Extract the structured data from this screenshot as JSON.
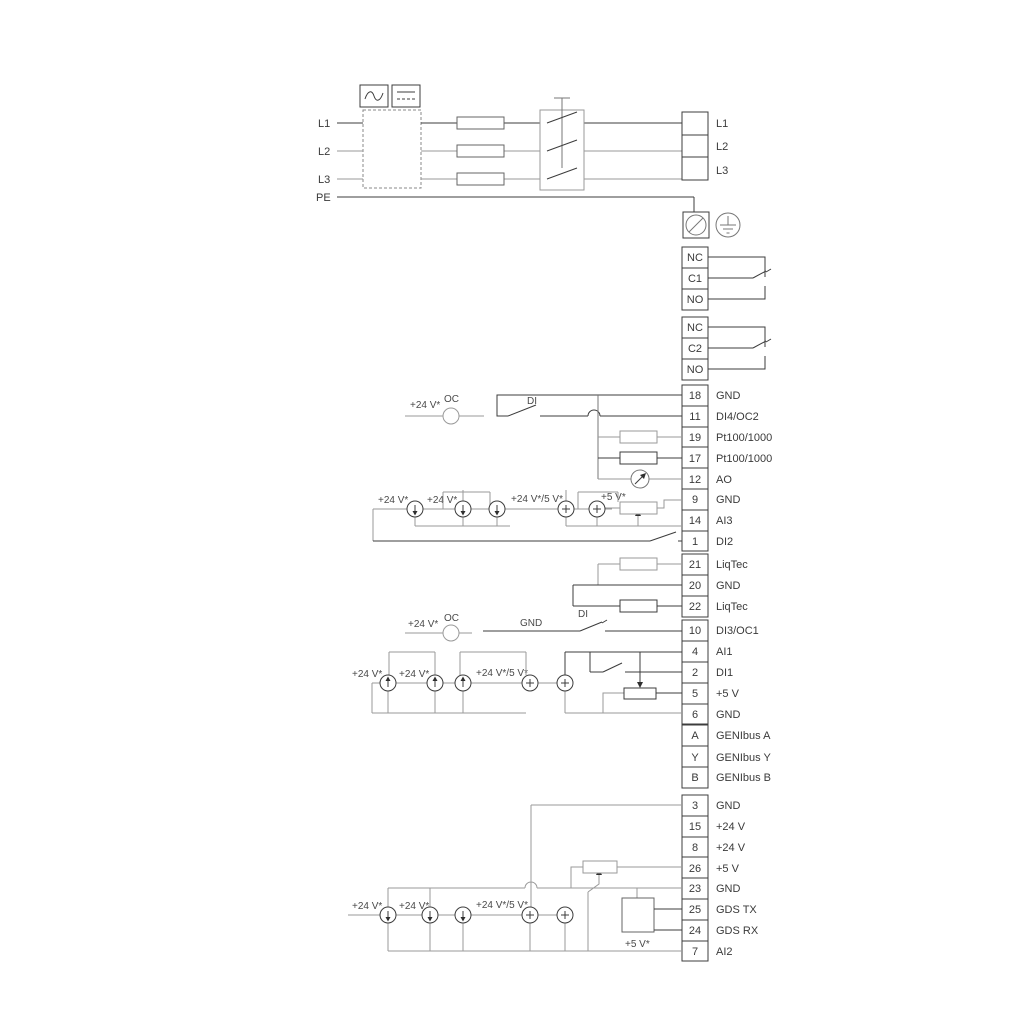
{
  "diagram": {
    "power": {
      "left": [
        "L1",
        "L2",
        "L3",
        "PE"
      ],
      "right": [
        "L1",
        "L2",
        "L3"
      ]
    },
    "relay1": {
      "nc": "NC",
      "common": "C1",
      "no": "NO"
    },
    "relay2": {
      "nc": "NC",
      "common": "C2",
      "no": "NO"
    },
    "strip1": {
      "rows": [
        {
          "num": "18",
          "label": "GND"
        },
        {
          "num": "11",
          "label": "DI4/OC2"
        },
        {
          "num": "19",
          "label": "Pt100/1000"
        },
        {
          "num": "17",
          "label": "Pt100/1000"
        },
        {
          "num": "12",
          "label": "AO"
        },
        {
          "num": "9",
          "label": "GND"
        },
        {
          "num": "14",
          "label": "AI3"
        },
        {
          "num": "1",
          "label": "DI2"
        }
      ]
    },
    "strip2": {
      "rows": [
        {
          "num": "21",
          "label": "LiqTec"
        },
        {
          "num": "20",
          "label": "GND"
        },
        {
          "num": "22",
          "label": "LiqTec"
        }
      ]
    },
    "strip3": {
      "rows": [
        {
          "num": "10",
          "label": "DI3/OC1"
        },
        {
          "num": "4",
          "label": "AI1"
        },
        {
          "num": "2",
          "label": "DI1"
        },
        {
          "num": "5",
          "label": "+5 V"
        },
        {
          "num": "6",
          "label": "GND"
        }
      ]
    },
    "genibus": {
      "rows": [
        {
          "num": "A",
          "label": "GENIbus A"
        },
        {
          "num": "Y",
          "label": "GENIbus Y"
        },
        {
          "num": "B",
          "label": "GENIbus B"
        }
      ]
    },
    "strip4": {
      "rows": [
        {
          "num": "3",
          "label": "GND"
        },
        {
          "num": "15",
          "label": "+24 V"
        },
        {
          "num": "8",
          "label": "+24 V"
        },
        {
          "num": "26",
          "label": "+5 V"
        },
        {
          "num": "23",
          "label": "GND"
        },
        {
          "num": "25",
          "label": "GDS TX"
        },
        {
          "num": "24",
          "label": "GDS RX"
        },
        {
          "num": "7",
          "label": "AI2"
        }
      ]
    },
    "labels": {
      "v24": "+24 V*",
      "v24v5": "+24 V*/5 V*",
      "v5": "+5 V*",
      "oc": "OC",
      "di": "DI",
      "gnd": "GND"
    }
  }
}
